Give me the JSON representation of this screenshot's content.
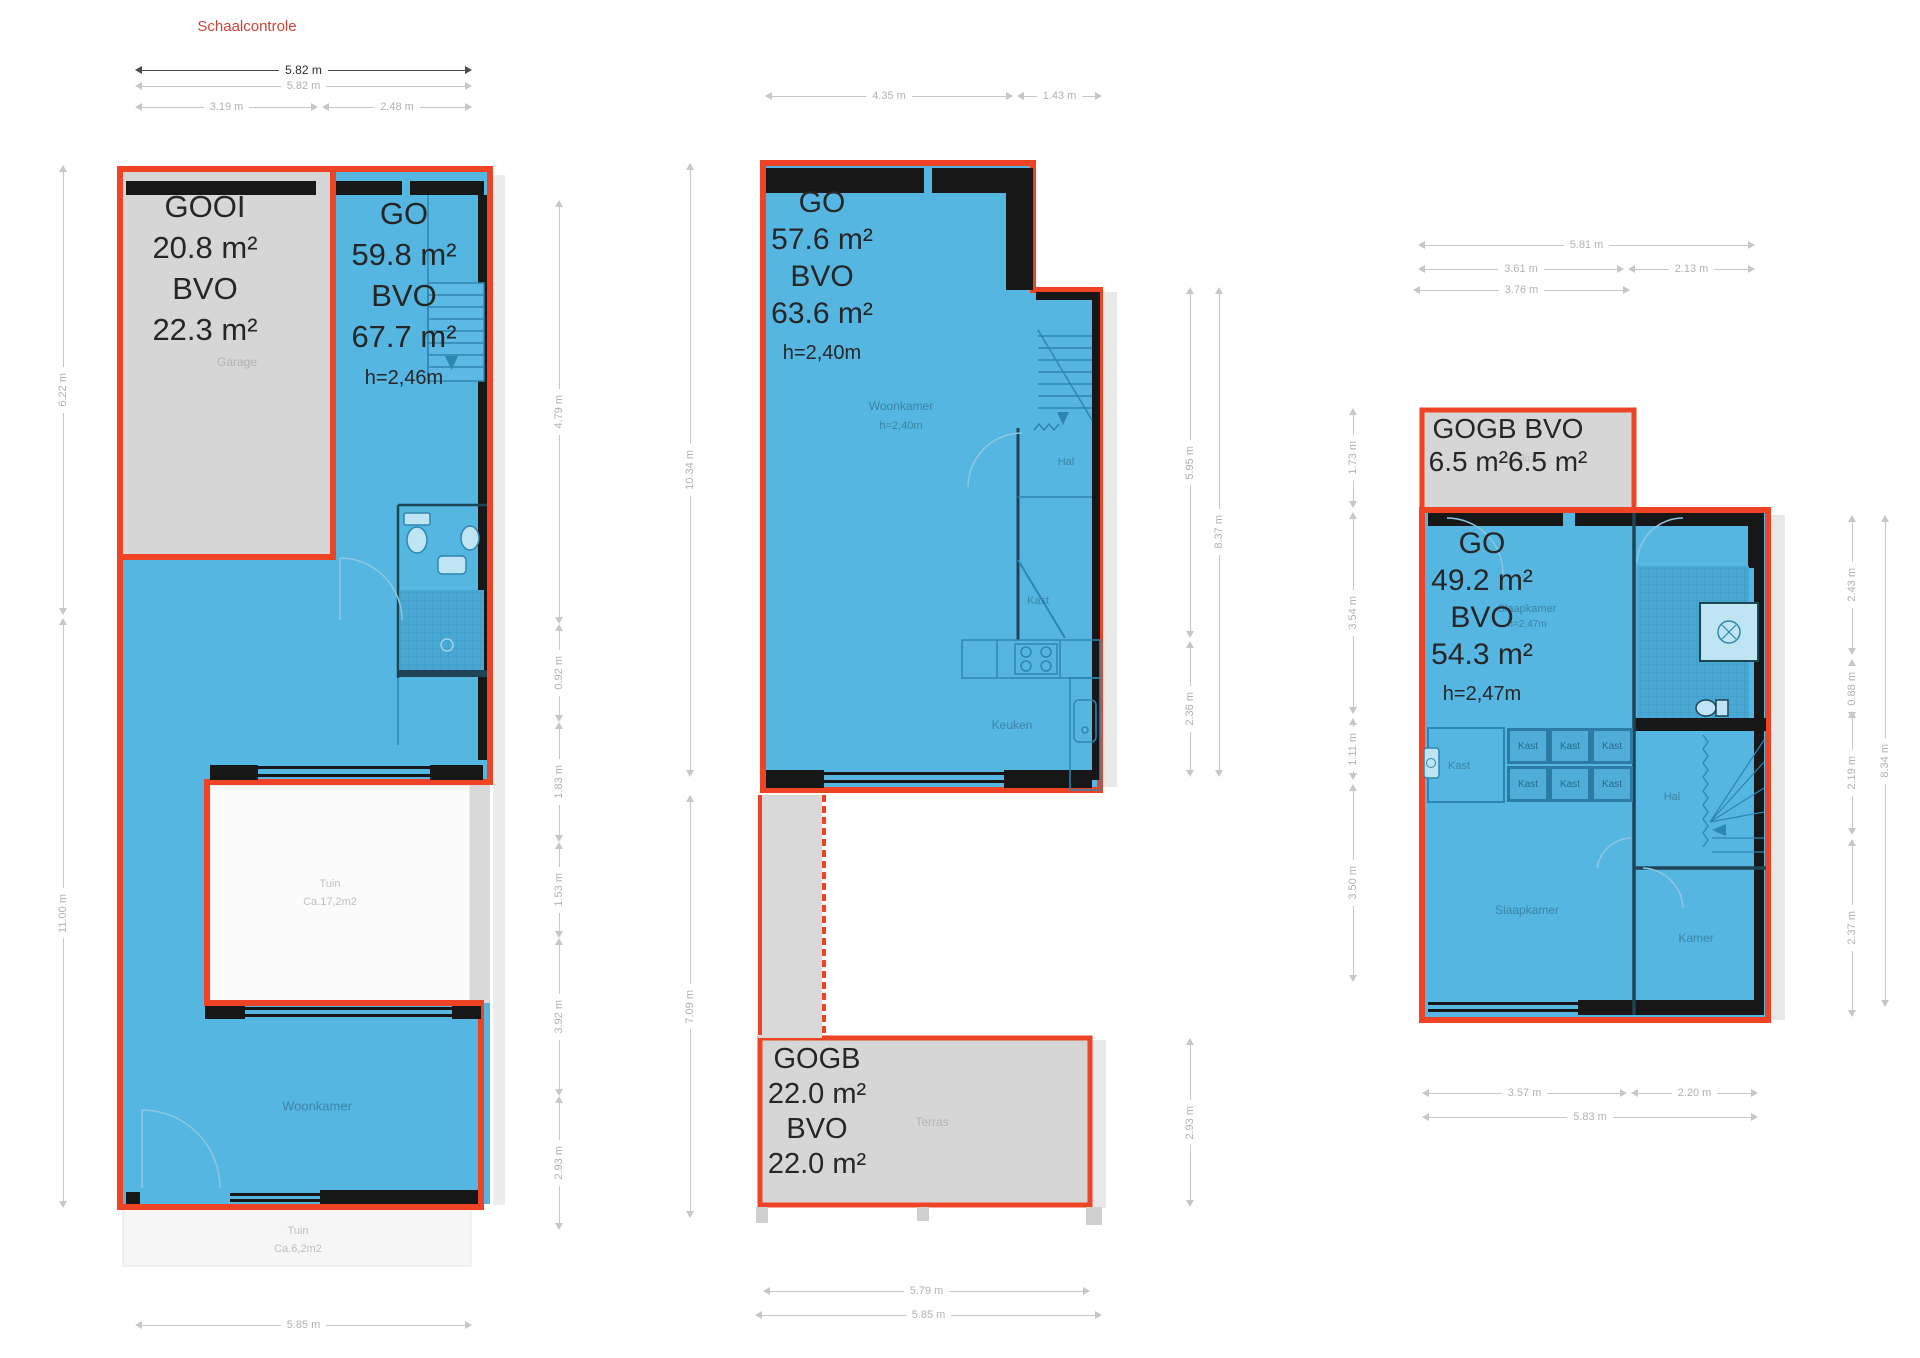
{
  "colors": {
    "outline_red": "#ee4425",
    "fill_blue": "#55b6e2",
    "fill_gray": "#d6d6d6",
    "wall_black": "#171717",
    "title_red": "#cc4437"
  },
  "title": "Schaalcontrole",
  "plan1": {
    "dims_top": {
      "total_dark": "5.82 m",
      "total_light": "5.82 m",
      "left": "3.19 m",
      "right": "2.48 m"
    },
    "dims_left": [
      "6.22 m",
      "11.00 m"
    ],
    "dims_right": [
      "4.79 m",
      "0.92 m",
      "1.83 m",
      "1.53 m",
      "3.92 m",
      "2.93 m"
    ],
    "dim_bottom": "5.85 m",
    "gooi_label": [
      "GOOI",
      "20.8 m²",
      "BVO",
      "22.3 m²"
    ],
    "go_label": [
      "GO",
      "59.8 m²",
      "BVO",
      "67.7 m²"
    ],
    "go_height": "h=2,46m",
    "rooms": {
      "garage": "Garage",
      "woonkamer": "Woonkamer",
      "tuin_inner": [
        "Tuin",
        "Ca.17,2m2"
      ],
      "tuin_lower": [
        "Tuin",
        "Ca.6,2m2"
      ]
    }
  },
  "plan2": {
    "dims_top": [
      "4.35 m",
      "1.43 m"
    ],
    "dims_left": [
      "10.34 m",
      "7.09 m"
    ],
    "dims_right_inner": [
      "5.95 m",
      "2.36 m"
    ],
    "dim_right_outer": "8.37 m",
    "dim_terras": "2.93 m",
    "dims_bottom": [
      "5.79 m",
      "5.85 m"
    ],
    "go_label": [
      "GO",
      "57.6 m²",
      "BVO",
      "63.6 m²"
    ],
    "go_height": "h=2,40m",
    "gogb_label": [
      "GOGB",
      "22.0 m²",
      "BVO",
      "22.0 m²"
    ],
    "rooms": {
      "woonkamer": "Woonkamer",
      "woonkamer_height": "h=2,40m",
      "hal": "Hal",
      "kast": "Kast",
      "keuken": "Keuken",
      "terras": "Terras"
    }
  },
  "plan3": {
    "dims_top": {
      "total": "5.81 m",
      "left": "3.61 m",
      "right": "2.13 m",
      "partial": "3.76 m"
    },
    "dims_left": [
      "1.73 m",
      "3.54 m",
      "1.11 m",
      "3.50 m"
    ],
    "dims_right_inner": [
      "2.43 m",
      "0.88 m",
      "2.19 m",
      "2.37 m"
    ],
    "dim_right_outer": "8.34 m",
    "dims_bottom": {
      "left": "3.57 m",
      "right": "2.20 m",
      "total": "5.83 m"
    },
    "gogb_label": {
      "line1": "GOGB BVO",
      "value1": "6.5 m²",
      "value2": "6.5 m²",
      "behind": "Balkon"
    },
    "go_label": [
      "GO",
      "49.2 m²",
      "BVO",
      "54.3 m²"
    ],
    "go_height": "h=2,47m",
    "rooms": {
      "slaapkamer_top": "Slaapkamer",
      "slaapkamer_top_height": "h=2,47m",
      "kast_large": "Kast",
      "kast_cells": [
        "Kast",
        "Kast",
        "Kast",
        "Kast",
        "Kast",
        "Kast"
      ],
      "hal": "Hal",
      "slaapkamer": "Slaapkamer",
      "kamer": "Kamer"
    }
  }
}
